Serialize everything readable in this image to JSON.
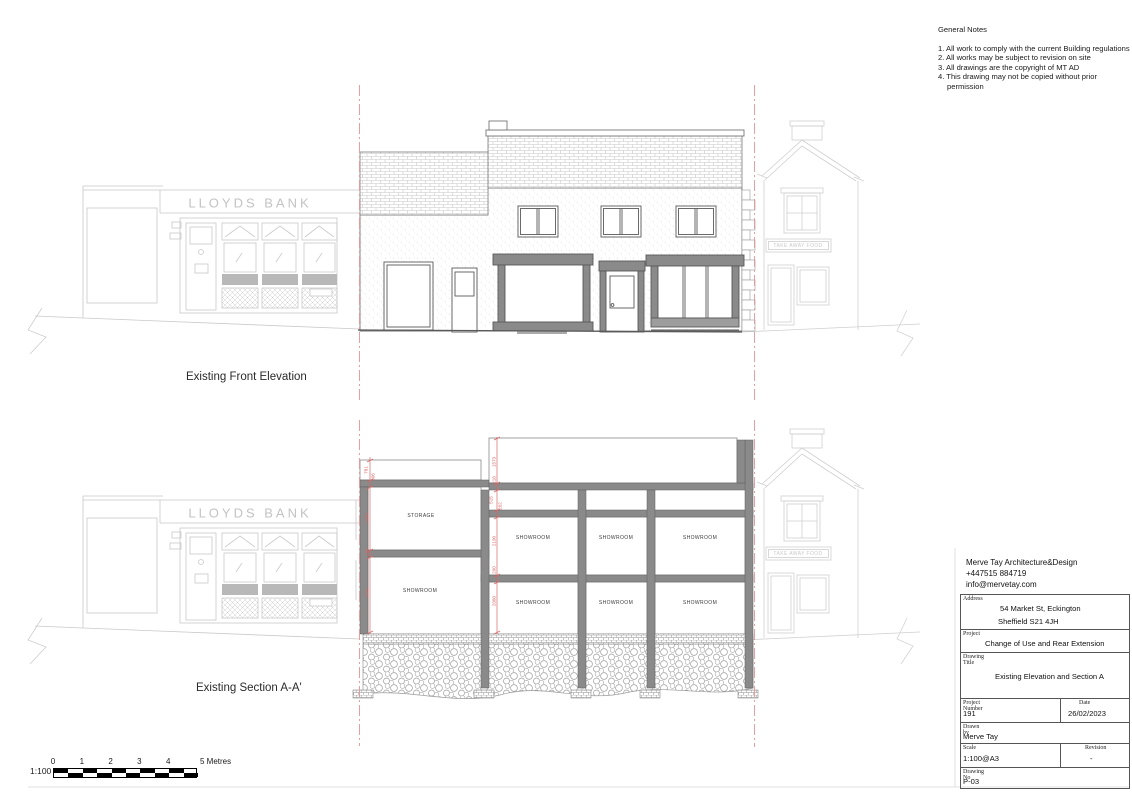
{
  "general_notes": {
    "title": "General Notes",
    "items": [
      "1. All work to comply with the current Building regulations",
      "2. All works may be subject to revision on site",
      "3. All drawings are the copyright of MT AD",
      "4. This drawing may not be copied without prior permission"
    ]
  },
  "signage": {
    "lloyds": "LLOYDS BANK",
    "takeaway": "TAKE AWAY FOOD"
  },
  "elevation": {
    "label": "Existing Front Elevation"
  },
  "section": {
    "label": "Existing Section A-A'",
    "storage_label": "STORAGE",
    "showroom_label": "SHOWROOM",
    "dims_left": [
      "781",
      "306",
      "2330",
      "260",
      "2332"
    ],
    "dims_mid": [
      "1573",
      "218",
      "515",
      "202",
      "2190",
      "200",
      "2080"
    ]
  },
  "scale_bar": {
    "ratio": "1:100",
    "ticks": [
      "0",
      "1",
      "2",
      "3",
      "4"
    ],
    "end_label": "5 Metres"
  },
  "title_block": {
    "firm": "Merve Tay Architecture&Design",
    "phone": "+447515 884719",
    "email": "info@mervetay.com",
    "address_label": "Address",
    "address_line1": "54 Market St, Eckington",
    "address_line2": "Sheffield S21 4JH",
    "project_label": "Project",
    "project": "Change of Use and Rear Extension",
    "drawing_title_label": "Drawing Title",
    "drawing_title": "Existing Elevation and Section A",
    "project_number_label": "Project Number",
    "project_number": "191",
    "date_label": "Date",
    "date": "26/02/2023",
    "drawn_by_label": "Drawn by",
    "drawn_by": "Merve Tay",
    "scale_label": "Scale",
    "scale": "1:100@A3",
    "revision_label": "Revision",
    "revision": "-",
    "drawing_no_label": "Drawing No",
    "drawing_no": "P-03"
  },
  "colors": {
    "dim_red": "#d96666",
    "boundary_red": "#e59595",
    "context_gray": "#c9c9c9",
    "frame_gray": "#8a8a8a",
    "line_dark": "#555555"
  }
}
